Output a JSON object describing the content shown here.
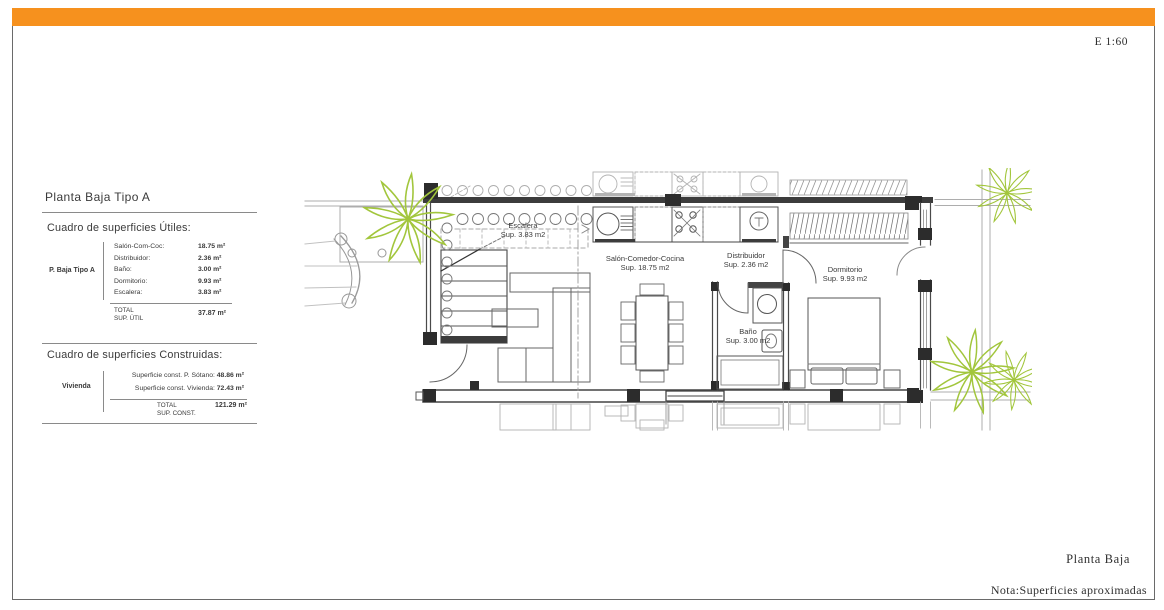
{
  "window": {
    "topbar_style": "background:#f6911e"
  },
  "colors": {
    "accent": "#f6911e",
    "plant_green": "#a2c63c",
    "wall_dark": "#3c3c3c",
    "ghost_gray": "#b3b3b3"
  },
  "scale_label": "E 1:60",
  "footer": {
    "plan_title": "Planta Baja",
    "note": "Nota:Superficies aproximadas"
  },
  "panel": {
    "title": "Planta Baja Tipo A",
    "useful": {
      "heading": "Cuadro de superficies Útiles:",
      "group_label": "P. Baja Tipo A",
      "rows": [
        {
          "label": "Salón-Com-Coc:",
          "value": "18.75 m²"
        },
        {
          "label": "Distribuidor:",
          "value": "2.36 m²"
        },
        {
          "label": "Baño:",
          "value": "3.00 m²"
        },
        {
          "label": "Dormitorio:",
          "value": "9.93 m²"
        },
        {
          "label": "Escalera:",
          "value": "3.83 m²"
        }
      ],
      "total_label": "TOTAL",
      "total_sublabel": "SUP. ÚTIL",
      "total_value": "37.87 m²"
    },
    "built": {
      "heading": "Cuadro de superficies Construidas:",
      "group_label": "Vivienda",
      "rows": [
        {
          "label": "Superficie const. P. Sótano:",
          "value": "48.86 m²"
        },
        {
          "label": "Superficie const. Vivienda:",
          "value": "72.43 m²"
        }
      ],
      "total_label": "TOTAL",
      "total_sublabel": "SUP. CONST.",
      "total_value": "121.29 m²"
    }
  },
  "plan": {
    "rooms": [
      {
        "name": "Escalera",
        "area": "Sup. 3.83 m2"
      },
      {
        "name": "Salón-Comedor-Cocina",
        "area": "Sup. 18.75 m2"
      },
      {
        "name": "Distribuidor",
        "area": "Sup. 2.36 m2"
      },
      {
        "name": "Dormitorio",
        "area": "Sup. 9.93 m2"
      },
      {
        "name": "Baño",
        "area": "Sup. 3.00 m2"
      }
    ]
  }
}
